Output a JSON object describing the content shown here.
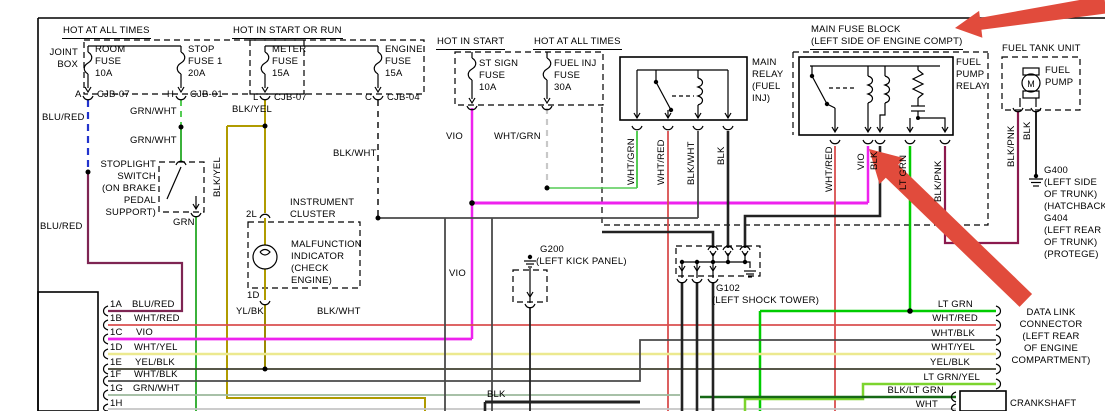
{
  "headers": {
    "hot_at_all_times": "HOT AT ALL TIMES",
    "hot_in_start_or_run": "HOT IN START OR RUN",
    "hot_in_start": "HOT IN START",
    "hot_at_all_times_2": "HOT AT ALL TIMES",
    "main_fuse_block": "MAIN FUSE BLOCK\n(LEFT SIDE OF ENGINE COMPT)",
    "fuel_tank_unit": "FUEL TANK UNIT"
  },
  "components": {
    "joint_box": "JOINT\nBOX",
    "room_fuse": "ROOM\nFUSE\n10A",
    "stop_fuse": "STOP\nFUSE 1\n20A",
    "meter_fuse": "METER\nFUSE\n15A",
    "engine_fuse": "ENGINE\nFUSE\n15A",
    "st_sign_fuse": "ST SIGN\nFUSE\n10A",
    "fuel_inj_fuse": "FUEL INJ\nFUSE\n30A",
    "main_relay": "MAIN\nRELAY\n(FUEL\nINJ)",
    "fuel_pump_relay": "FUEL\nPUMP\nRELAY",
    "fuel_pump": "FUEL\nPUMP",
    "motor": "M",
    "stoplight_switch": "STOPLIGHT\nSWITCH\n(ON BRAKE\nPEDAL\nSUPPORT)",
    "instrument_cluster": "INSTRUMENT\nCLUSTER",
    "malfunction_indicator": "MALFUNCTION\nINDICATOR\n(CHECK\nENGINE)",
    "crankshaft": "CRANKSHAFT"
  },
  "grounds": {
    "g200": "G200",
    "g200_loc": "(LEFT KICK PANEL)",
    "g102": "G102",
    "g102_loc": "(LEFT SHOCK TOWER)",
    "g400_block": "G400\n(LEFT SIDE\nOF TRUNK)\n(HATCHBACK)\nG404\n(LEFT REAR\nOF TRUNK)\n(PROTEGE)"
  },
  "data_link_connector": "DATA LINK\nCONNECTOR\n(LEFT REAR\nOF ENGINE\nCOMPARTMENT)",
  "connectors": {
    "a": "A",
    "cjb07": "CJB-07",
    "h": "H",
    "cjb01": "CJB-01",
    "l": "L",
    "cjb07b": "CJB-07",
    "c": "C",
    "cjb04": "CJB-04",
    "p2l": "2L",
    "p1d": "1D"
  },
  "pins_left": {
    "a": "1A",
    "b": "1B",
    "c": "1C",
    "d": "1D",
    "e": "1E",
    "f": "1F",
    "g": "1G",
    "h": "1H"
  },
  "wires": {
    "blu_red": "BLU/RED",
    "grn_wht": "GRN/WHT",
    "blk_yel": "BLK/YEL",
    "grn": "GRN",
    "vio": "VIO",
    "wht_grn": "WHT/GRN",
    "blk_wht": "BLK/WHT",
    "wht_red": "WHT/RED",
    "blk": "BLK",
    "yl_bk": "YL/BK",
    "lt_grn": "LT GRN",
    "blk_pnk": "BLK/PNK",
    "wht_yel": "WHT/YEL",
    "yel_blk": "YEL/BLK",
    "wht_blk": "WHT/BLK",
    "lt_grn_yel": "LT GRN/YEL",
    "blk_lt_grn": "BLK/LT GRN",
    "wht": "WHT"
  },
  "colors": {
    "background": "#ffffff",
    "line": "#000000",
    "blu_red_dash": "#2233cc",
    "blu_red": "#7e2553",
    "grn_wht": "#55cc55",
    "blk_yel": "#b09b00",
    "yl_bk": "#9b8b00",
    "grn": "#3bb13b",
    "vio": "#ee22ee",
    "wht_grn_dash": "#c8c8c8",
    "wht_red": "#d94f4f",
    "blk": "#222222",
    "blk_wht": "#4a4a4a",
    "lt_grn": "#00cc00",
    "blk_pnk": "#8b1a4e",
    "wht_yel": "#ece98f",
    "yel_blk": "#3f3f2f",
    "wht_blk": "#4a4a4a",
    "grn_wht_row": "#9cb89c",
    "lt_grn_yel": "#7cd42e",
    "blk_lt_grn": "#156815",
    "wht": "#c4c4c4",
    "red_arrow": "#e14b3c"
  }
}
